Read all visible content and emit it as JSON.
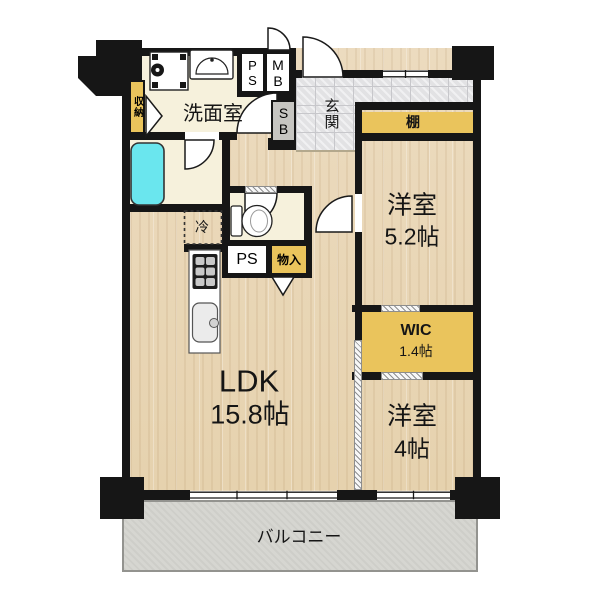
{
  "floor_plan": {
    "ldk": {
      "name": "LDK",
      "area": "15.8帖"
    },
    "bedroom_52": {
      "name": "洋室",
      "area": "5.2帖"
    },
    "bedroom_4": {
      "name": "洋室",
      "area": "4帖"
    },
    "wic": {
      "name": "WIC",
      "area": "1.4帖"
    },
    "washroom": {
      "name": "洗面室"
    },
    "entrance": {
      "name": "玄関"
    },
    "balcony": {
      "name": "バルコニー"
    },
    "shelf": {
      "name": "棚"
    },
    "storage": {
      "name": "収納"
    },
    "closet": {
      "name": "物入"
    },
    "refrigerator": {
      "name": "冷"
    },
    "pipe_shaft_top": {
      "name": "PS"
    },
    "meter_box": {
      "name": "MB"
    },
    "shoe_box": {
      "name": "SB"
    },
    "pipe_shaft": {
      "name": "PS"
    },
    "colors": {
      "wall": "#161616",
      "wood_floor": "#ead8ba",
      "sheet_floor": "#f6f1dc",
      "accent_yellow": "#eac45c",
      "entrance_tile": "#e2e2e4",
      "balcony": "#d6d6d1",
      "bathtub": "#6ae6ee"
    }
  }
}
